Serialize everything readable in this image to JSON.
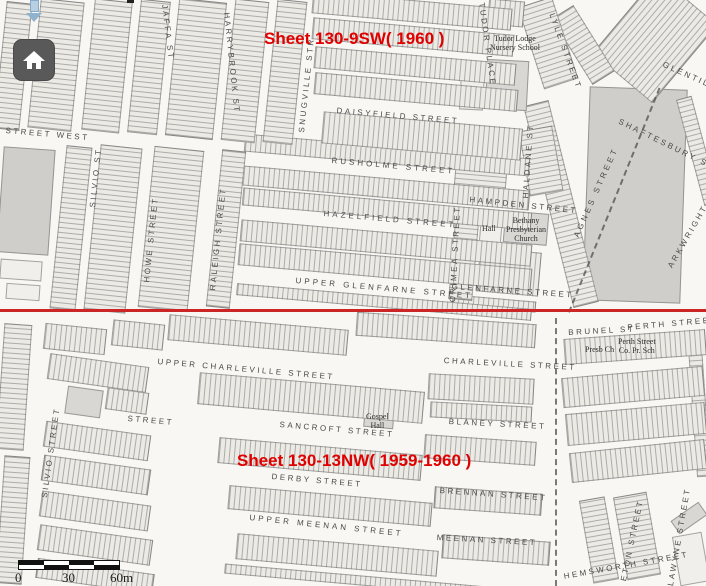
{
  "map_viewer": {
    "boundary_annotations": {
      "top_sheet": "Sheet 130-9SW( 1960 )",
      "bottom_sheet": "Sheet 130-13NW( 1959-1960 )",
      "text_color": "#e00000",
      "boundary_line_color": "#cc2525"
    },
    "controls": {
      "home_button_icon": "home-icon",
      "marker_icon": "map-marker-icon"
    },
    "scale_bar": {
      "tick_labels": [
        "0",
        "30",
        "60m"
      ]
    },
    "street_labels": [
      {
        "text": "STREET WEST",
        "x": 6,
        "y": 126,
        "rot": 5
      },
      {
        "text": "JAFFA ST",
        "x": 169,
        "y": 4,
        "rot": 83
      },
      {
        "text": "HARRYBROOK ST",
        "x": 231,
        "y": 12,
        "rot": 84
      },
      {
        "text": "SNUGVILLE STR",
        "x": 297,
        "y": 132,
        "rot": -84
      },
      {
        "text": "DAISYFIELD STREET",
        "x": 337,
        "y": 106,
        "rot": 5
      },
      {
        "text": "RUSHOLME STREET",
        "x": 332,
        "y": 156,
        "rot": 5,
        "ls": 3
      },
      {
        "text": "HAZELFIELD STREET",
        "x": 324,
        "y": 209,
        "rot": 5,
        "ls": 3
      },
      {
        "text": "UPPER GLENFARNE STREET",
        "x": 296,
        "y": 276,
        "rot": 5,
        "ls": 3
      },
      {
        "text": "GLENFARNE STREET",
        "x": 452,
        "y": 282,
        "rot": 4
      },
      {
        "text": "SILVIO ST",
        "x": 88,
        "y": 207,
        "rot": -84
      },
      {
        "text": "HOWE STREET",
        "x": 142,
        "y": 282,
        "rot": -84
      },
      {
        "text": "RALEIGH STREET",
        "x": 208,
        "y": 290,
        "rot": -84
      },
      {
        "text": "CRIMEA STREET",
        "x": 448,
        "y": 302,
        "rot": -87
      },
      {
        "text": "HALDANE ST",
        "x": 521,
        "y": 198,
        "rot": -86
      },
      {
        "text": "HAMPDEN STREET",
        "x": 470,
        "y": 195,
        "rot": 6
      },
      {
        "text": "TUDOR PLACE",
        "x": 486,
        "y": 2,
        "rot": 82
      },
      {
        "text": "LYLE STREET",
        "x": 556,
        "y": 12,
        "rot": 70
      },
      {
        "text": "GLENTILT ST",
        "x": 665,
        "y": 60,
        "rot": 24
      },
      {
        "text": "SHAFTESBURY STREET",
        "x": 621,
        "y": 117,
        "rot": 26
      },
      {
        "text": "AGNES STREET",
        "x": 572,
        "y": 235,
        "rot": -66,
        "ls": 3
      },
      {
        "text": "ARKWRIGHT ST",
        "x": 666,
        "y": 265,
        "rot": -60
      },
      {
        "text": "PERTH STREET",
        "x": 627,
        "y": 323,
        "rot": -5
      },
      {
        "text": "BRUNEL ST",
        "x": 568,
        "y": 328,
        "rot": -3
      },
      {
        "text": "UPPER CHARLEVILLE STREET",
        "x": 158,
        "y": 357,
        "rot": 5
      },
      {
        "text": "CHARLEVILLE STREET",
        "x": 444,
        "y": 356,
        "rot": 3
      },
      {
        "text": "STREET",
        "x": 128,
        "y": 414,
        "rot": 5
      },
      {
        "text": "SANCROFT STREET",
        "x": 280,
        "y": 420,
        "rot": 5
      },
      {
        "text": "BLANEY STREET",
        "x": 449,
        "y": 417,
        "rot": 3
      },
      {
        "text": "SILVIO STREET",
        "x": 40,
        "y": 497,
        "rot": -82
      },
      {
        "text": "DERBY STREET",
        "x": 272,
        "y": 472,
        "rot": 5
      },
      {
        "text": "BRENNAN STREET",
        "x": 440,
        "y": 486,
        "rot": 4
      },
      {
        "text": "UPPER MEENAN STREET",
        "x": 250,
        "y": 513,
        "rot": 6,
        "ls": 3
      },
      {
        "text": "MEENAN STREET",
        "x": 437,
        "y": 533,
        "rot": 3
      },
      {
        "text": "HEMSWORTH STREET",
        "x": 563,
        "y": 572,
        "rot": -10
      },
      {
        "text": "ETON STREET",
        "x": 619,
        "y": 580,
        "rot": -78
      },
      {
        "text": "LAWYNE STREET",
        "x": 666,
        "y": 585,
        "rot": -80
      }
    ],
    "poi_labels": [
      {
        "text": "Tudor Lodge\nNursery School",
        "x": 490,
        "y": 34
      },
      {
        "text": "Bethany\nPresbyterian\nChurch",
        "x": 506,
        "y": 216
      },
      {
        "text": "Hall",
        "x": 482,
        "y": 224
      },
      {
        "text": "Presb Ch",
        "x": 585,
        "y": 345
      },
      {
        "text": "Perth Street\nCo. Pr. Sch",
        "x": 618,
        "y": 337
      },
      {
        "text": "Gospel\nHall",
        "x": 366,
        "y": 412
      }
    ]
  }
}
